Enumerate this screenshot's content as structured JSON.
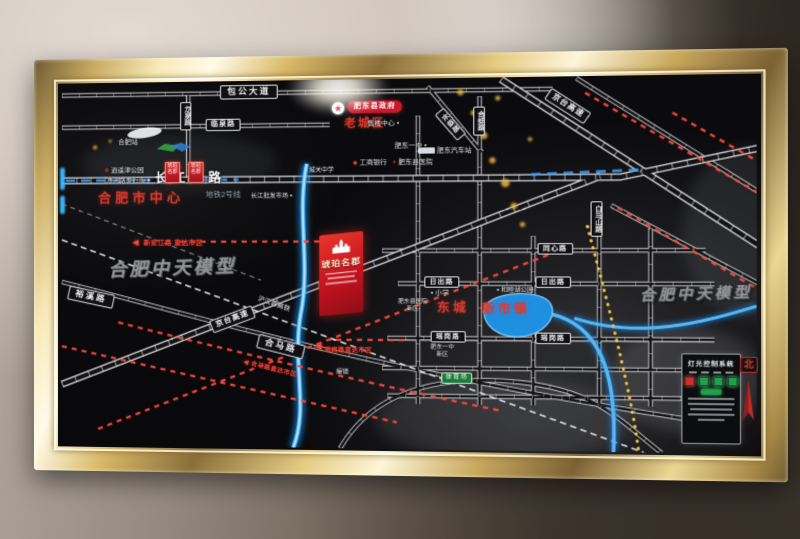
{
  "watermarks": {
    "left": "合肥中天模型",
    "right": "合肥中天模型"
  },
  "project": {
    "name": "琥珀名郡",
    "banner_a": "琥珀名郡",
    "banner_b": "琥珀名郡"
  },
  "roads": {
    "baogong": "包公大道",
    "linquan": "临泉路",
    "longquan": "龙泉路",
    "changjiang_east": "长江东路",
    "metro_line2": "地铁2号线",
    "hebeng": "合蚌路",
    "changlin": "长临路",
    "baimashan": "白马山路",
    "jingtai_top": "京台高速",
    "jingtai_bottom": "京台高速",
    "yuxi": "裕溪路",
    "hema": "合马路",
    "hsr": "沪汉蓉高铁",
    "tongxin": "同心路",
    "richu_w": "日出路",
    "richu_e": "日出路",
    "yaogang_w": "瑶岗路",
    "yaogang_e": "瑶岗路"
  },
  "places": {
    "hefei_center": "合肥市中心",
    "old_town": "老城区",
    "county_gov": "肥东县政府",
    "sales_center": "售楼中心",
    "hefei_station": "合肥站",
    "xiaoyaojin_park": "逍遥津公园",
    "huaihe_walkstreet": "淮河路步行街",
    "changjiang_market": "长江批发市场",
    "feidong_no1_school": "肥东一中",
    "bus_station": "肥东汽车站",
    "county_hospital": "肥东县医院",
    "icbc_bank": "工商银行",
    "chengguan_school": "城关中学",
    "dongcheng": "东城",
    "xinshizhen": "新市镇",
    "hemu_lake_park": "和睦湖公园",
    "primary_school": "小学",
    "hospital_new_name": "肥东县医院",
    "hospital_new_tag": "新区",
    "school_new_name": "肥东一中",
    "school_new_tag": "新区",
    "stadium": "体育场",
    "cuozhen": "撮镇"
  },
  "directions": {
    "xinanjiang": "新安江路 直达市区",
    "yaogang": "瑶岗路直达市区",
    "hema": "合马路直达市区"
  },
  "panel": {
    "title": "灯光控制系统"
  },
  "compass": {
    "north": "北"
  },
  "colors": {
    "frame_gold": "#d9b968",
    "board_black": "#0a0a0c",
    "accent_red": "#e03a2e",
    "project_red": "#c8192b",
    "led_blue": "#35aaff",
    "led_red": "#ff4838",
    "led_yellow": "#f6c63e",
    "panel_btn_red": "#d03028",
    "panel_btn_green": "#1fa14a"
  }
}
